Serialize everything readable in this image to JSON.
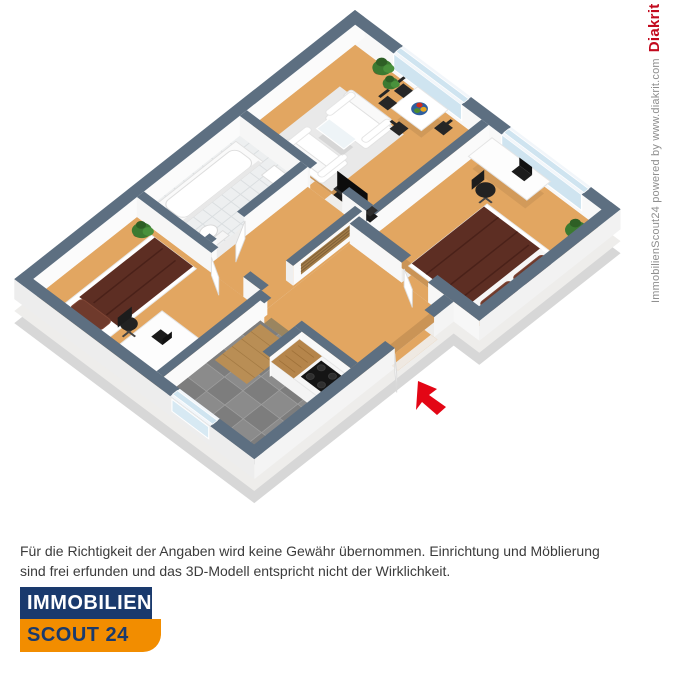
{
  "watermark": {
    "credit": "ImmobilienScout24 powered by www.diakrit.com",
    "brand": "Diakrit"
  },
  "disclaimer": {
    "line1": "Für die Richtigkeit der Angaben wird keine Gewähr übernommen. Einrichtung und Möblierung",
    "line2": "sind frei erfunden und das 3D-Modell entspricht nicht der Wirklichkeit."
  },
  "logo": {
    "top": "IMMOBILIEN",
    "bottom": "SCOUT 24"
  },
  "icons": {
    "entrance_arrow": "red-cursor-arrow-pointing-to-entrance"
  },
  "colors": {
    "wall_top": "#5d6f81",
    "floor_wood": "#e2a661",
    "bed_textile": "#5d2e23",
    "kitchen_tile": "#8b8b8b",
    "window_glass": "#cfe4f0",
    "arrow_red": "#e30615",
    "logo_blue": "#1a3a6d",
    "logo_orange": "#f28d00",
    "brand_red": "#c20a1e",
    "background": "#ffffff"
  }
}
